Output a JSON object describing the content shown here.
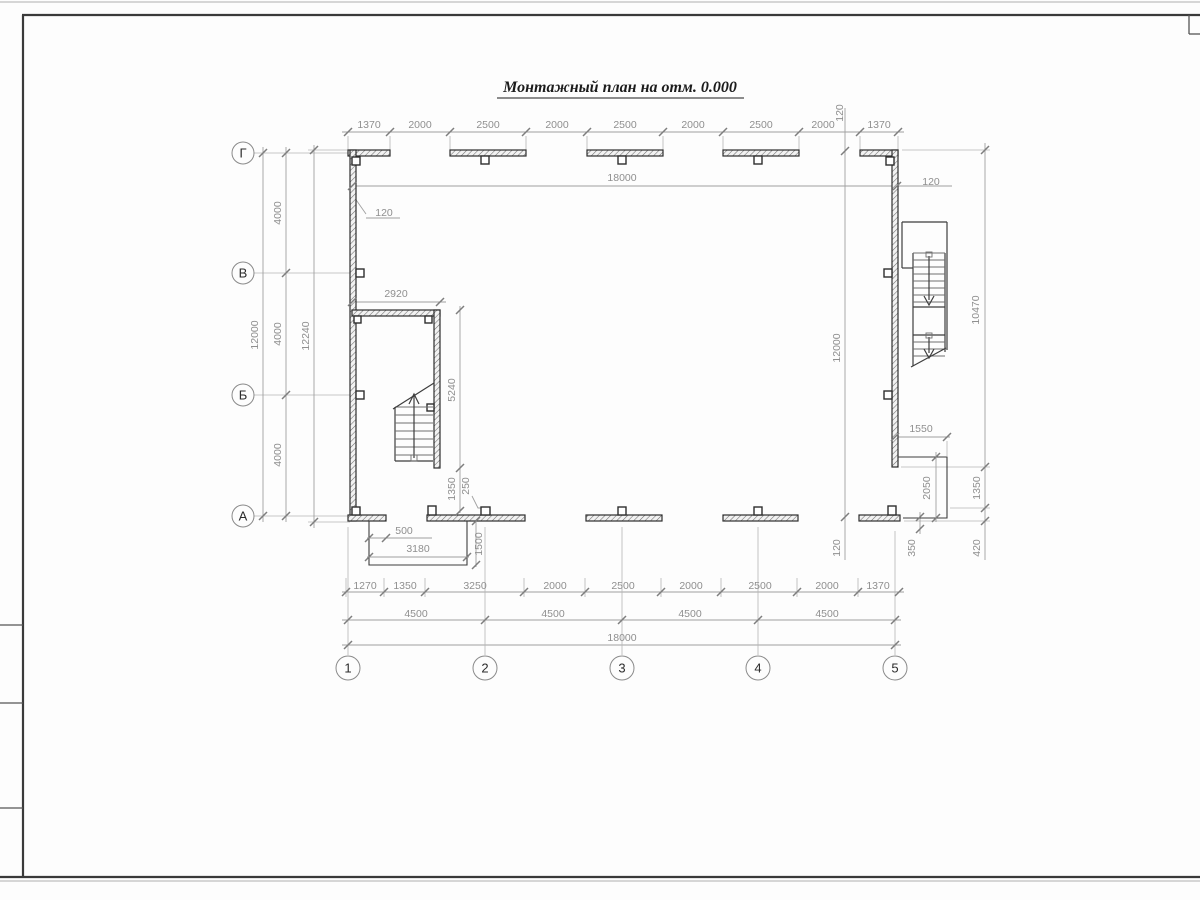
{
  "sheet": {
    "title": "Монтажный план на отм. 0.000"
  },
  "axes": {
    "rows": [
      {
        "label": "Г",
        "y": 153
      },
      {
        "label": "В",
        "y": 273
      },
      {
        "label": "Б",
        "y": 395
      },
      {
        "label": "А",
        "y": 516
      }
    ],
    "cols": [
      {
        "label": "1",
        "x": 348
      },
      {
        "label": "2",
        "x": 485
      },
      {
        "label": "3",
        "x": 622
      },
      {
        "label": "4",
        "x": 758
      },
      {
        "label": "5",
        "x": 895
      }
    ]
  },
  "dimensions": {
    "top_chain": [
      "1370",
      "2000",
      "2500",
      "2000",
      "2500",
      "2000",
      "2500",
      "2000",
      "1370"
    ],
    "top_overall": "18000",
    "bottom_chain_1": [
      "1270",
      "1350",
      "3250",
      "2000",
      "2500",
      "2000",
      "2500",
      "2000",
      "1370"
    ],
    "bottom_chain_2": [
      "4500",
      "4500",
      "4500",
      "4500"
    ],
    "bottom_overall": "18000",
    "left_chain": [
      "4000",
      "4000",
      "4000"
    ],
    "left_axis_total": "12000",
    "left_outer_total": "12240",
    "right_axis_total": "12000",
    "right_outer": [
      "10470",
      "1350",
      "420"
    ],
    "wall_thickness": "120",
    "stair_room_width": "2920",
    "stair_room_height": "5240",
    "stair_door": [
      "1350",
      "250"
    ],
    "porch_left": [
      "500",
      "3180",
      "1500"
    ],
    "porch_right": [
      "1550",
      "2050",
      "350",
      "420"
    ]
  },
  "dim_labels": [
    {
      "t": "1370",
      "x": 369,
      "y": 128
    },
    {
      "t": "2000",
      "x": 420,
      "y": 128
    },
    {
      "t": "2500",
      "x": 488,
      "y": 128
    },
    {
      "t": "2000",
      "x": 557,
      "y": 128
    },
    {
      "t": "2500",
      "x": 625,
      "y": 128
    },
    {
      "t": "2000",
      "x": 693,
      "y": 128
    },
    {
      "t": "2500",
      "x": 761,
      "y": 128
    },
    {
      "t": "2000",
      "x": 823,
      "y": 128
    },
    {
      "t": "1370",
      "x": 879,
      "y": 128
    },
    {
      "t": "120",
      "x": 843,
      "y": 113,
      "r": -90
    },
    {
      "t": "18000",
      "x": 622,
      "y": 181
    },
    {
      "t": "120",
      "x": 931,
      "y": 185
    },
    {
      "t": "120",
      "x": 384,
      "y": 216
    },
    {
      "t": "2920",
      "x": 396,
      "y": 297
    },
    {
      "t": "12000",
      "x": 258,
      "y": 335,
      "r": -90
    },
    {
      "t": "4000",
      "x": 281,
      "y": 213,
      "r": -90
    },
    {
      "t": "4000",
      "x": 281,
      "y": 334,
      "r": -90
    },
    {
      "t": "4000",
      "x": 281,
      "y": 455,
      "r": -90
    },
    {
      "t": "12240",
      "x": 309,
      "y": 336,
      "r": -90
    },
    {
      "t": "5240",
      "x": 455,
      "y": 390,
      "r": -90
    },
    {
      "t": "1350",
      "x": 455,
      "y": 489,
      "r": -90
    },
    {
      "t": "250",
      "x": 469,
      "y": 486,
      "r": -90
    },
    {
      "t": "500",
      "x": 404,
      "y": 534
    },
    {
      "t": "3180",
      "x": 418,
      "y": 552
    },
    {
      "t": "1500",
      "x": 482,
      "y": 544,
      "r": -90
    },
    {
      "t": "1550",
      "x": 921,
      "y": 432
    },
    {
      "t": "2050",
      "x": 930,
      "y": 488,
      "r": -90
    },
    {
      "t": "12000",
      "x": 840,
      "y": 348,
      "r": -90
    },
    {
      "t": "10470",
      "x": 979,
      "y": 310,
      "r": -90
    },
    {
      "t": "1350",
      "x": 980,
      "y": 488,
      "r": -90
    },
    {
      "t": "120",
      "x": 840,
      "y": 548,
      "r": -90
    },
    {
      "t": "350",
      "x": 915,
      "y": 548,
      "r": -90
    },
    {
      "t": "420",
      "x": 980,
      "y": 548,
      "r": -90
    },
    {
      "t": "1270",
      "x": 365,
      "y": 589
    },
    {
      "t": "1350",
      "x": 405,
      "y": 589
    },
    {
      "t": "3250",
      "x": 475,
      "y": 589
    },
    {
      "t": "2000",
      "x": 555,
      "y": 589
    },
    {
      "t": "2500",
      "x": 623,
      "y": 589
    },
    {
      "t": "2000",
      "x": 691,
      "y": 589
    },
    {
      "t": "2500",
      "x": 760,
      "y": 589
    },
    {
      "t": "2000",
      "x": 827,
      "y": 589
    },
    {
      "t": "1370",
      "x": 878,
      "y": 589
    },
    {
      "t": "4500",
      "x": 416,
      "y": 617
    },
    {
      "t": "4500",
      "x": 553,
      "y": 617
    },
    {
      "t": "4500",
      "x": 690,
      "y": 617
    },
    {
      "t": "4500",
      "x": 827,
      "y": 617
    },
    {
      "t": "18000",
      "x": 622,
      "y": 641
    }
  ]
}
